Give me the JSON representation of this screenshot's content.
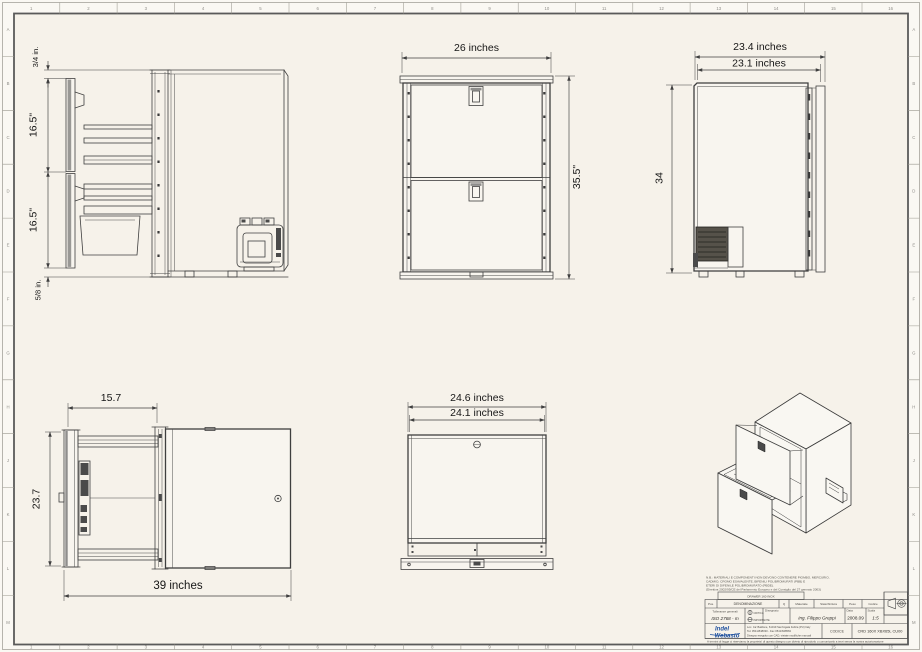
{
  "sheet": {
    "bg_outer": "#faf8f3",
    "bg_paper": "#f6f2ea",
    "line_color": "#3f3f3f",
    "accent_blue": "#1d4f9e",
    "zones_top": [
      "1",
      "2",
      "3",
      "4",
      "5",
      "6",
      "7",
      "8",
      "9",
      "10",
      "11",
      "12",
      "13",
      "14",
      "15",
      "16"
    ],
    "zones_bottom": [
      "1",
      "2",
      "3",
      "4",
      "5",
      "6",
      "7",
      "8",
      "9",
      "10",
      "11",
      "12",
      "13",
      "14",
      "15",
      "16"
    ],
    "zones_left": [
      "A",
      "B",
      "C",
      "D",
      "E",
      "F",
      "G",
      "H",
      "J",
      "K",
      "L",
      "M"
    ],
    "zones_right": [
      "A",
      "B",
      "C",
      "D",
      "E",
      "F",
      "G",
      "H",
      "J",
      "K",
      "L",
      "M"
    ]
  },
  "views": {
    "side_section": {
      "dim_top_gap": "3/4 in.",
      "dim_upper_drawer": "16.5\"",
      "dim_lower_drawer": "16.5\"",
      "dim_bottom_gap": "5/8 in."
    },
    "front": {
      "dim_width": "26 inches",
      "dim_height": "35.5\""
    },
    "side": {
      "dim_depth_overall": "23.4 inches",
      "dim_depth_body": "23.1 inches",
      "dim_height": "34"
    },
    "plan_open": {
      "dim_extension": "15.7",
      "dim_depth": "23.7",
      "dim_total": "39 inches"
    },
    "plan_top": {
      "dim_width_overall": "24.6 inches",
      "dim_width_body": "24.1 inches"
    }
  },
  "title_block": {
    "notes_1": "N.B.: MATERIALI E COMPONENTI NON DEVONO CONTENERE PIOMBO, MERCURIO,",
    "notes_2": "CADMIO, CROMO ESAVALENTE, BIFENILI POLIBROMURATI (PBB) E",
    "notes_3": "ETERI DI DIFENILE POLIBROMURATO (PBDE).",
    "notes_4": "(Direttiva 2002/95/CE del Parlamento Europeo e del Consiglio del 27 gennaio 2003)",
    "denomination_box": "DRAWER 160 INOX",
    "headers": {
      "pos": "Pos.",
      "denominazione": "DENOMINAZIONE",
      "q": "Q",
      "materiale": "Materiale",
      "stato": "Stato/finitura",
      "peso": "Peso",
      "codice": "Codice"
    },
    "tolerance_label": "Tolleranze generali",
    "tolerance_value": "ISO 2768 - m",
    "critica": "CRITICA",
    "importante": "IMPORTANTE",
    "drawn_label": "Disegnato",
    "drawn_by": "Ing. Filippo Greppi",
    "date_label": "Data",
    "date": "2008.09",
    "scale_label": "Scala",
    "scale": "1:5",
    "logo_line1": "Indel",
    "logo_line2": "Webasto",
    "address1": "Loc. Ca' Baldone, 61019 Sant'Agata Feltria (PU) Italy",
    "address2": "Tel. 0541/848030 - Fax 0541/848563",
    "cad_note": "Disegno eseguito con CAD, vietate modifiche manuali",
    "codice_label": "CODICE",
    "codice_value": "CRD 160X XBX65L CU00",
    "legal": "A termini di legge ci riserviamo la proprieta' di questo disegno con divieto di riprodurlo o comunicarlo a terzi senza la nostra autorizzazione"
  }
}
